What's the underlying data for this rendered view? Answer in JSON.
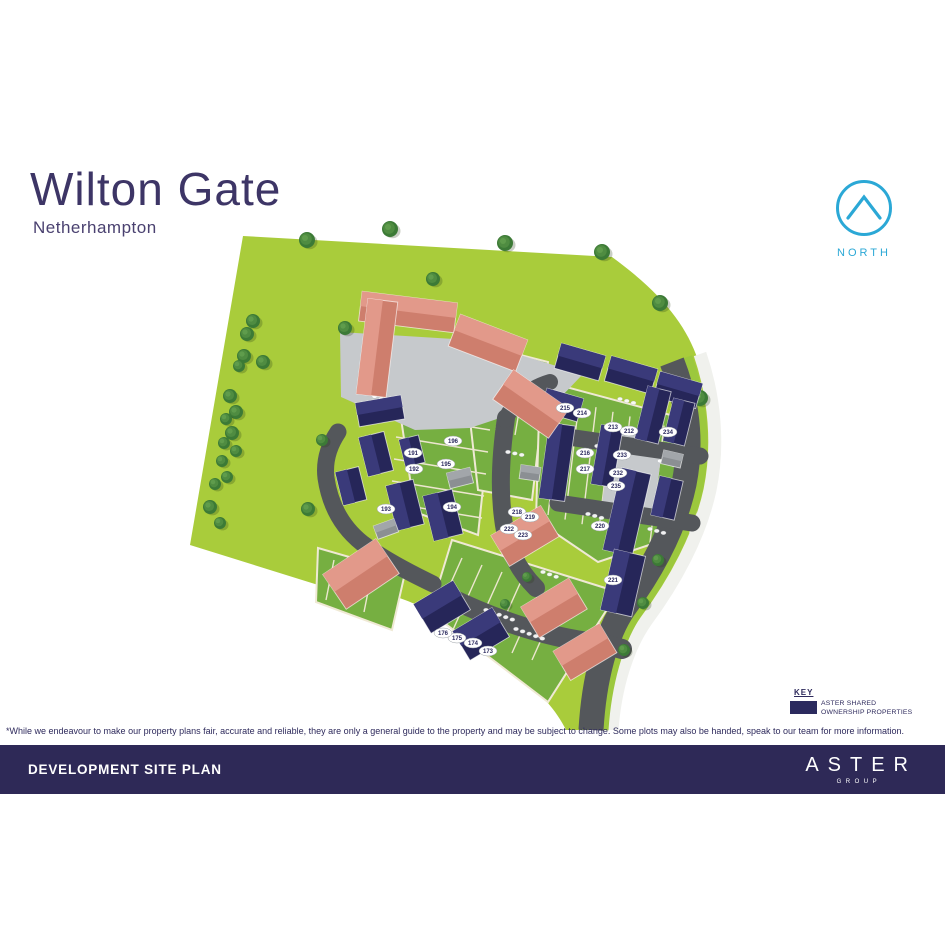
{
  "header": {
    "title": "Wilton Gate",
    "subtitle": "Netherhampton"
  },
  "north": {
    "label": "NORTH",
    "color": "#2BA8D6"
  },
  "key": {
    "heading": "KEY",
    "swatch_color": "#2B2A5E",
    "label_line1": "ASTER SHARED",
    "label_line2": "OWNERSHIP PROPERTIES"
  },
  "disclaimer": "*While we endeavour to make our property plans fair, accurate and reliable, they are only a general guide to the property and may be subject to change. Some plots may also be handed, speak to our team for more information.",
  "footer": {
    "title": "DEVELOPMENT SITE PLAN",
    "brand": "ASTER",
    "brand_sub": "GROUP",
    "bg": "#2E2957"
  },
  "site_plan": {
    "development_name": "Wilton Gate",
    "colors": {
      "field": "#A9CC3B",
      "garden": "#76AF41",
      "road": "#54575B",
      "footpath": "#F0F1ED",
      "verge": "#9CC83D",
      "gravel": "#C6C9CC",
      "aster_house": "#2A2A5F",
      "private_house": "#D78D7C",
      "plot_line": "#ECE6CF",
      "tree": "#3C7A36"
    },
    "plots": [
      {
        "number": "173",
        "x": 488,
        "y": 651
      },
      {
        "number": "174",
        "x": 473,
        "y": 643
      },
      {
        "number": "175",
        "x": 457,
        "y": 638
      },
      {
        "number": "176",
        "x": 443,
        "y": 633
      },
      {
        "number": "191",
        "x": 413,
        "y": 453
      },
      {
        "number": "192",
        "x": 414,
        "y": 469
      },
      {
        "number": "193",
        "x": 386,
        "y": 509
      },
      {
        "number": "194",
        "x": 452,
        "y": 507
      },
      {
        "number": "195",
        "x": 446,
        "y": 464
      },
      {
        "number": "196",
        "x": 453,
        "y": 441
      },
      {
        "number": "212",
        "x": 629,
        "y": 431
      },
      {
        "number": "213",
        "x": 613,
        "y": 427
      },
      {
        "number": "214",
        "x": 582,
        "y": 413
      },
      {
        "number": "215",
        "x": 565,
        "y": 408
      },
      {
        "number": "216",
        "x": 585,
        "y": 453
      },
      {
        "number": "217",
        "x": 585,
        "y": 469
      },
      {
        "number": "218",
        "x": 517,
        "y": 512
      },
      {
        "number": "219",
        "x": 530,
        "y": 517
      },
      {
        "number": "220",
        "x": 600,
        "y": 526
      },
      {
        "number": "221",
        "x": 613,
        "y": 580
      },
      {
        "number": "222",
        "x": 509,
        "y": 529
      },
      {
        "number": "223",
        "x": 523,
        "y": 535
      },
      {
        "number": "232",
        "x": 618,
        "y": 473
      },
      {
        "number": "233",
        "x": 622,
        "y": 455
      },
      {
        "number": "234",
        "x": 668,
        "y": 432
      },
      {
        "number": "235",
        "x": 616,
        "y": 486
      }
    ]
  }
}
